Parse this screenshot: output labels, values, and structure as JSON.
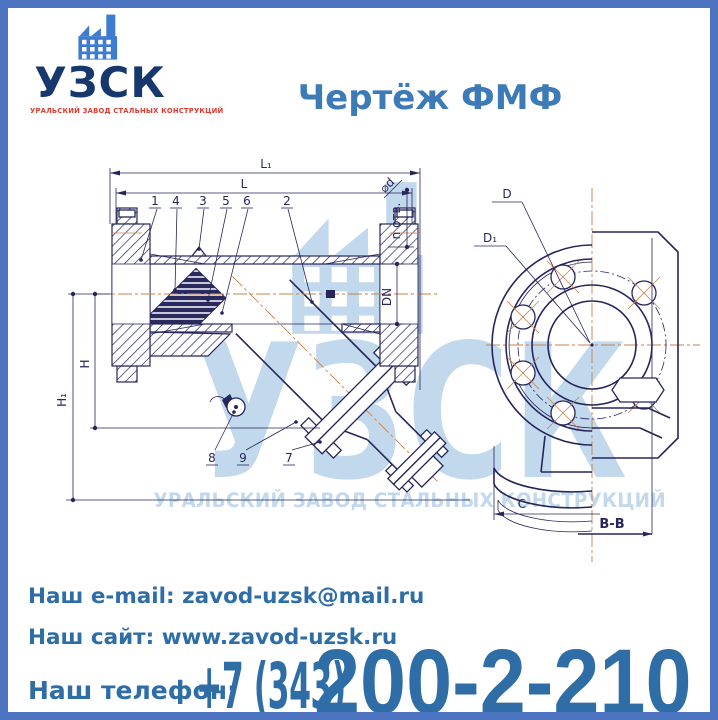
{
  "colors": {
    "border": "#4d74c0",
    "title_text": "#3c7ab8",
    "footer_text": "#2e6da6",
    "logo_name": "#16386e",
    "logo_icon": "#3d7cd0",
    "logo_subtitle": "#e23a2e",
    "watermark": "#c2d8ec",
    "drawing_line": "#26265c",
    "drawing_centerline": "#c8824f"
  },
  "logo": {
    "name": "УЗСК",
    "subtitle": "УРАЛЬСКИЙ ЗАВОД СТАЛЬНЫХ КОНСТРУКЦИЙ"
  },
  "title": "Чертёж ФМФ",
  "watermark": {
    "name": "УЗСК",
    "subtitle": "УРАЛЬСКИЙ ЗАВОД СТАЛЬНЫХ КОНСТРУКЦИЙ"
  },
  "drawing": {
    "dims": {
      "l1": "L₁",
      "l": "L",
      "h": "H",
      "h1": "H₁",
      "dn": "DN",
      "n_holes": "n отв.",
      "hole_dia": "⌀d",
      "d": "D",
      "d1": "D₁",
      "c": "C",
      "section": "В-В"
    },
    "callouts_top": [
      "1",
      "4",
      "3",
      "5",
      "6",
      "2"
    ],
    "callouts_bottom": [
      "8",
      "9",
      "7"
    ]
  },
  "footer": {
    "email_label": "Наш e-mail: ",
    "email_value": "zavod-uzsk@mail.ru",
    "site_label": "Наш сайт: ",
    "site_value": "www.zavod-uzsk.ru",
    "phone_label": "Наш телефон:",
    "phone_prefix": "+7 (343)",
    "phone_number": "200-2-210"
  }
}
